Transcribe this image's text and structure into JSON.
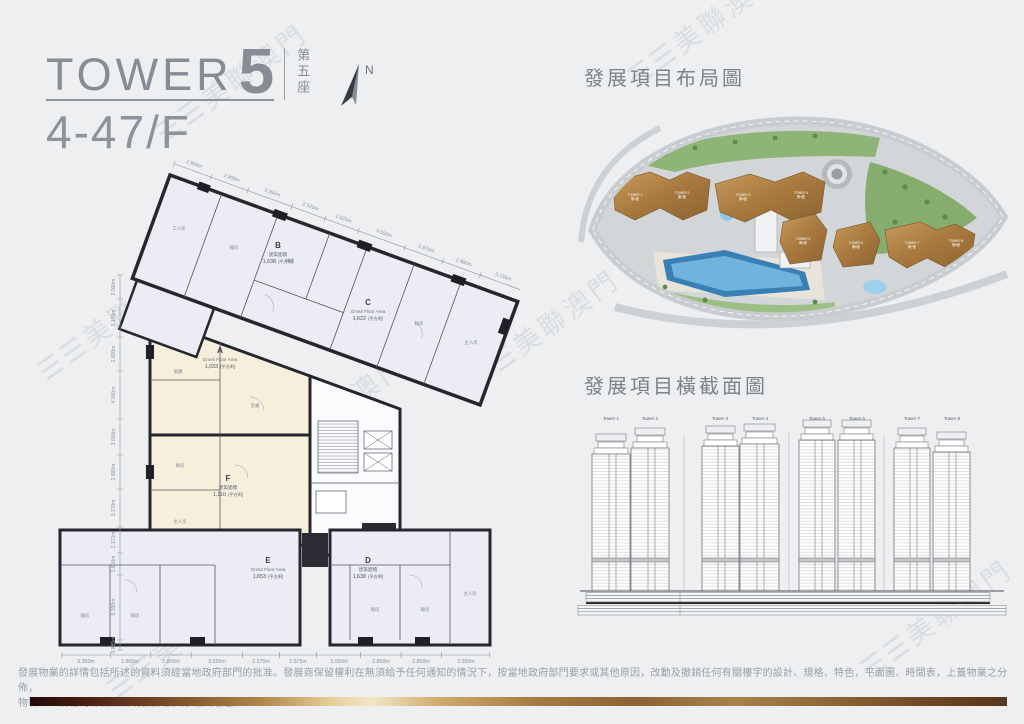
{
  "header": {
    "tower_en": "TOWER",
    "tower_no": "5",
    "tower_cn": "第五座",
    "floor_range": "4-47/F",
    "north": "N"
  },
  "watermark": {
    "bars": "☰☰",
    "text": "美聯澳門"
  },
  "floor_plan": {
    "units": [
      {
        "id": "A",
        "area_label": "Gross Floor Area",
        "area_value": "1,033",
        "area_unit": "(平方呎)"
      },
      {
        "id": "B",
        "area_label": "建築面積",
        "area_value": "1,638",
        "area_unit": "(平方呎)"
      },
      {
        "id": "C",
        "area_label": "Gross Floor Area",
        "area_value": "1,622",
        "area_unit": "(平方呎)"
      },
      {
        "id": "D",
        "area_label": "建築面積",
        "area_value": "1,638",
        "area_unit": "(平方呎)"
      },
      {
        "id": "E",
        "area_label": "Gross Floor Area",
        "area_value": "1,653",
        "area_unit": "(平方呎)"
      },
      {
        "id": "F",
        "area_label": "建築面積",
        "area_value": "1,110",
        "area_unit": "(平方呎)"
      }
    ],
    "rooms": [
      "工人房",
      "睡房",
      "睡房",
      "睡房",
      "主人房",
      "飯廳",
      "客廳",
      "睡房",
      "主人房",
      "睡房",
      "睡房",
      "睡房",
      "睡房",
      "主人房"
    ],
    "dims_top": [
      "2.800m",
      "2.800m",
      "3.350m",
      "2.520m",
      "2.525m",
      "3.550m",
      "2.870m",
      "2.860m",
      "3.150m"
    ],
    "dims_left": [
      "2.000m",
      "3.150m",
      "2.805m",
      "4.000m",
      "3.000m",
      "2.800m",
      "3.170m",
      "2.172m",
      "1.800m",
      "5.350m",
      "0.885m"
    ],
    "dims_bottom": [
      "3.350m",
      "2.800m",
      "2.800m",
      "3.550m",
      "2.575m",
      "2.575m",
      "3.050m",
      "2.800m",
      "2.800m",
      "3.350m"
    ]
  },
  "site_plan": {
    "title": "發展項目布局圖",
    "towers": [
      {
        "en": "TOWER 1",
        "cn": "第1座"
      },
      {
        "en": "TOWER 2",
        "cn": "第2座"
      },
      {
        "en": "TOWER 3",
        "cn": "第3座"
      },
      {
        "en": "TOWER 4",
        "cn": "第4座"
      },
      {
        "en": "TOWER 5",
        "cn": "第5座"
      },
      {
        "en": "TOWER 6",
        "cn": "第6座"
      },
      {
        "en": "TOWER 7",
        "cn": "第7座"
      },
      {
        "en": "TOWER 8",
        "cn": "第8座"
      }
    ]
  },
  "cross_section": {
    "title": "發展項目橫截面圖",
    "towers": [
      "Tower 1",
      "Tower 2",
      "Tower 3",
      "Tower 4",
      "Tower 5",
      "Tower 6",
      "Tower 7",
      "Tower 8"
    ]
  },
  "footer": {
    "line1": "發展物業的詳情包括所述的資料須經當地政府部門的批准。發展商保留權利在無須給予任何通知的情況下，按當地政府部門要求或其他原因，改動及撤銷任何有關樓宇的設計、規格、特色，平面圖、時間表，上蓋物業之分佈，",
    "line2": "物料、以及任何有關設備或服務之供應或其用途。"
  }
}
